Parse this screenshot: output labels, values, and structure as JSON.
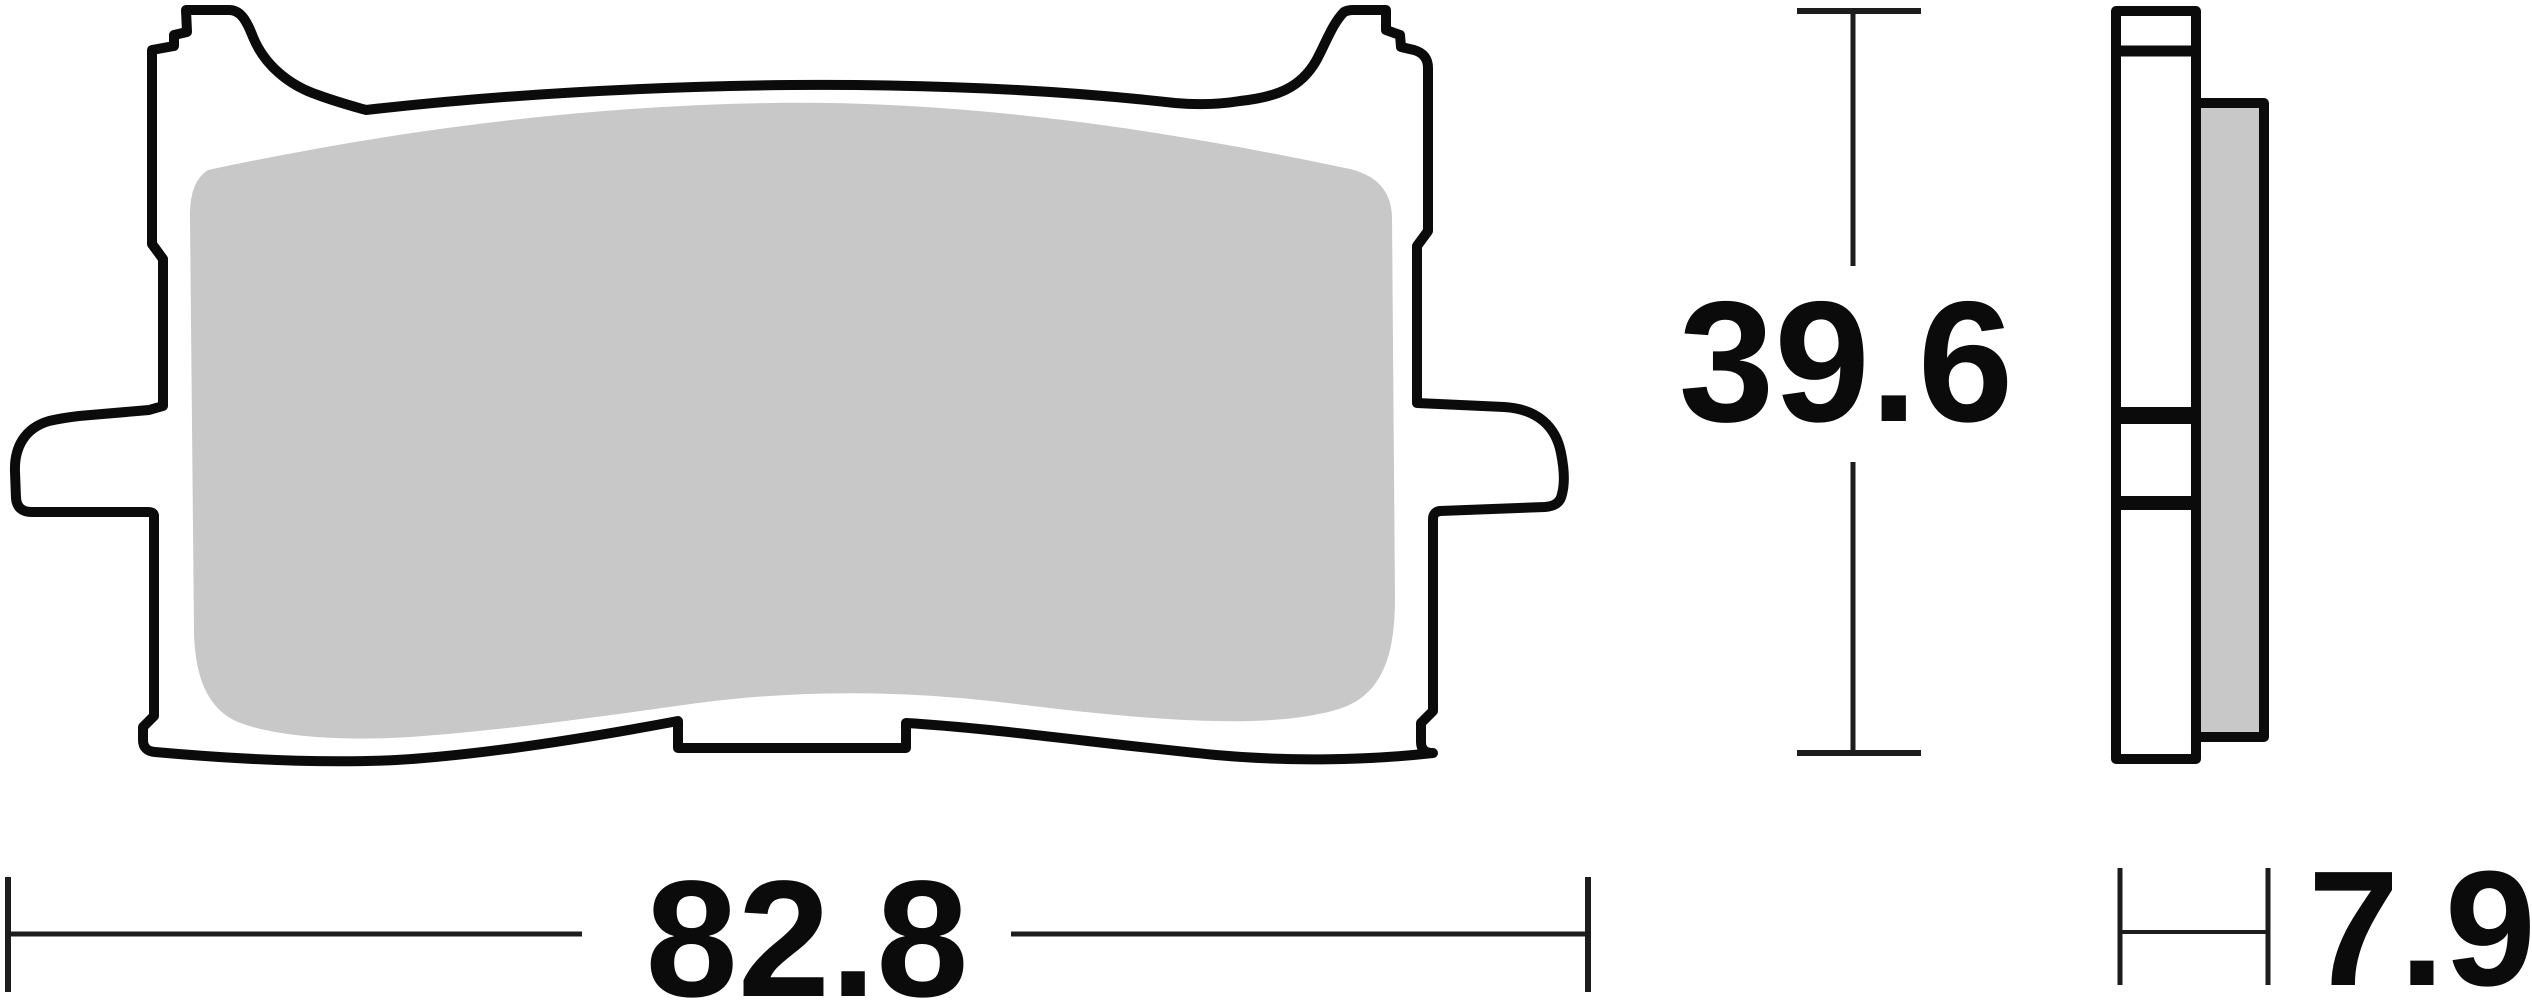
{
  "dimensions": {
    "width": {
      "label": "82.8"
    },
    "height": {
      "label": "39.6"
    },
    "thickness": {
      "label": "7.9"
    }
  },
  "colors": {
    "background": "#ffffff",
    "outline": "#0b0b0b",
    "plate_fill": "#ffffff",
    "friction_material": "#c7c8c7",
    "dimension_line": "#1d1d1d",
    "label_text": "#0b0b0b"
  }
}
